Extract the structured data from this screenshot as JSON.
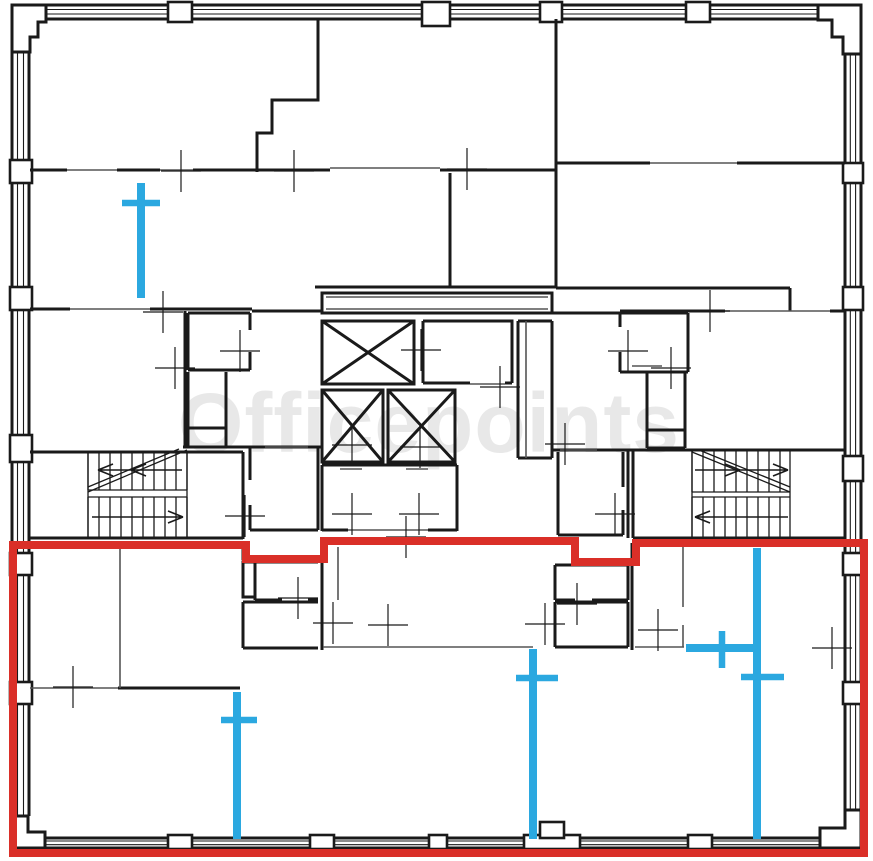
{
  "title": "office-floor-plan",
  "watermark": {
    "text": "Officepoints"
  },
  "colors": {
    "background": "#ffffff",
    "walls": "#1a1a1a",
    "partitions": "#555555",
    "highlight_red": "#da2f28",
    "marker_blue": "#2ba8e0",
    "watermark": "rgba(0,0,0,0.09)"
  },
  "selected_unit_outline": {
    "description": "red outline around selected bottom office unit",
    "stroke_width": 8,
    "closed": true,
    "points": [
      [
        13,
        545
      ],
      [
        246,
        545
      ],
      [
        246,
        559
      ],
      [
        324,
        559
      ],
      [
        324,
        541
      ],
      [
        575,
        541
      ],
      [
        575,
        562
      ],
      [
        636,
        562
      ],
      [
        636,
        543
      ],
      [
        864,
        543
      ],
      [
        864,
        853
      ],
      [
        13,
        853
      ]
    ]
  },
  "proposed_partition_markers": [
    {
      "id": "marker-1",
      "line": [
        [
          141,
          183
        ],
        [
          141,
          298
        ]
      ],
      "crossbar": [
        [
          122,
          203
        ],
        [
          160,
          203
        ]
      ]
    },
    {
      "id": "marker-2",
      "line": [
        [
          237,
          692
        ],
        [
          237,
          839
        ]
      ],
      "crossbar": [
        [
          221,
          720
        ],
        [
          257,
          720
        ]
      ]
    },
    {
      "id": "marker-3",
      "line": [
        [
          533,
          649
        ],
        [
          533,
          839
        ]
      ],
      "crossbar": [
        [
          516,
          678
        ],
        [
          558,
          678
        ]
      ]
    },
    {
      "id": "marker-4",
      "line": [
        [
          757,
          548
        ],
        [
          757,
          839
        ]
      ],
      "crossbar": [
        [
          741,
          677
        ],
        [
          784,
          677
        ]
      ]
    },
    {
      "id": "marker-5",
      "line": [
        [
          686,
          648
        ],
        [
          753,
          648
        ]
      ],
      "crossbar": [
        [
          722,
          631
        ],
        [
          722,
          668
        ]
      ]
    }
  ],
  "dimension_ticks": [
    [
      181,
      171
    ],
    [
      294,
      171
    ],
    [
      467,
      169
    ],
    [
      163,
      312
    ],
    [
      240,
      351
    ],
    [
      175,
      368
    ],
    [
      421,
      350
    ],
    [
      500,
      387
    ],
    [
      352,
      445
    ],
    [
      420,
      447
    ],
    [
      352,
      514
    ],
    [
      419,
      514
    ],
    [
      628,
      351
    ],
    [
      671,
      368
    ],
    [
      710,
      311
    ],
    [
      245,
      516
    ],
    [
      615,
      514
    ],
    [
      565,
      444
    ],
    [
      406,
      537
    ],
    [
      298,
      598
    ],
    [
      333,
      623
    ],
    [
      388,
      625
    ],
    [
      545,
      624
    ],
    [
      577,
      604
    ],
    [
      658,
      630
    ],
    [
      73,
      687
    ],
    [
      832,
      648
    ]
  ]
}
